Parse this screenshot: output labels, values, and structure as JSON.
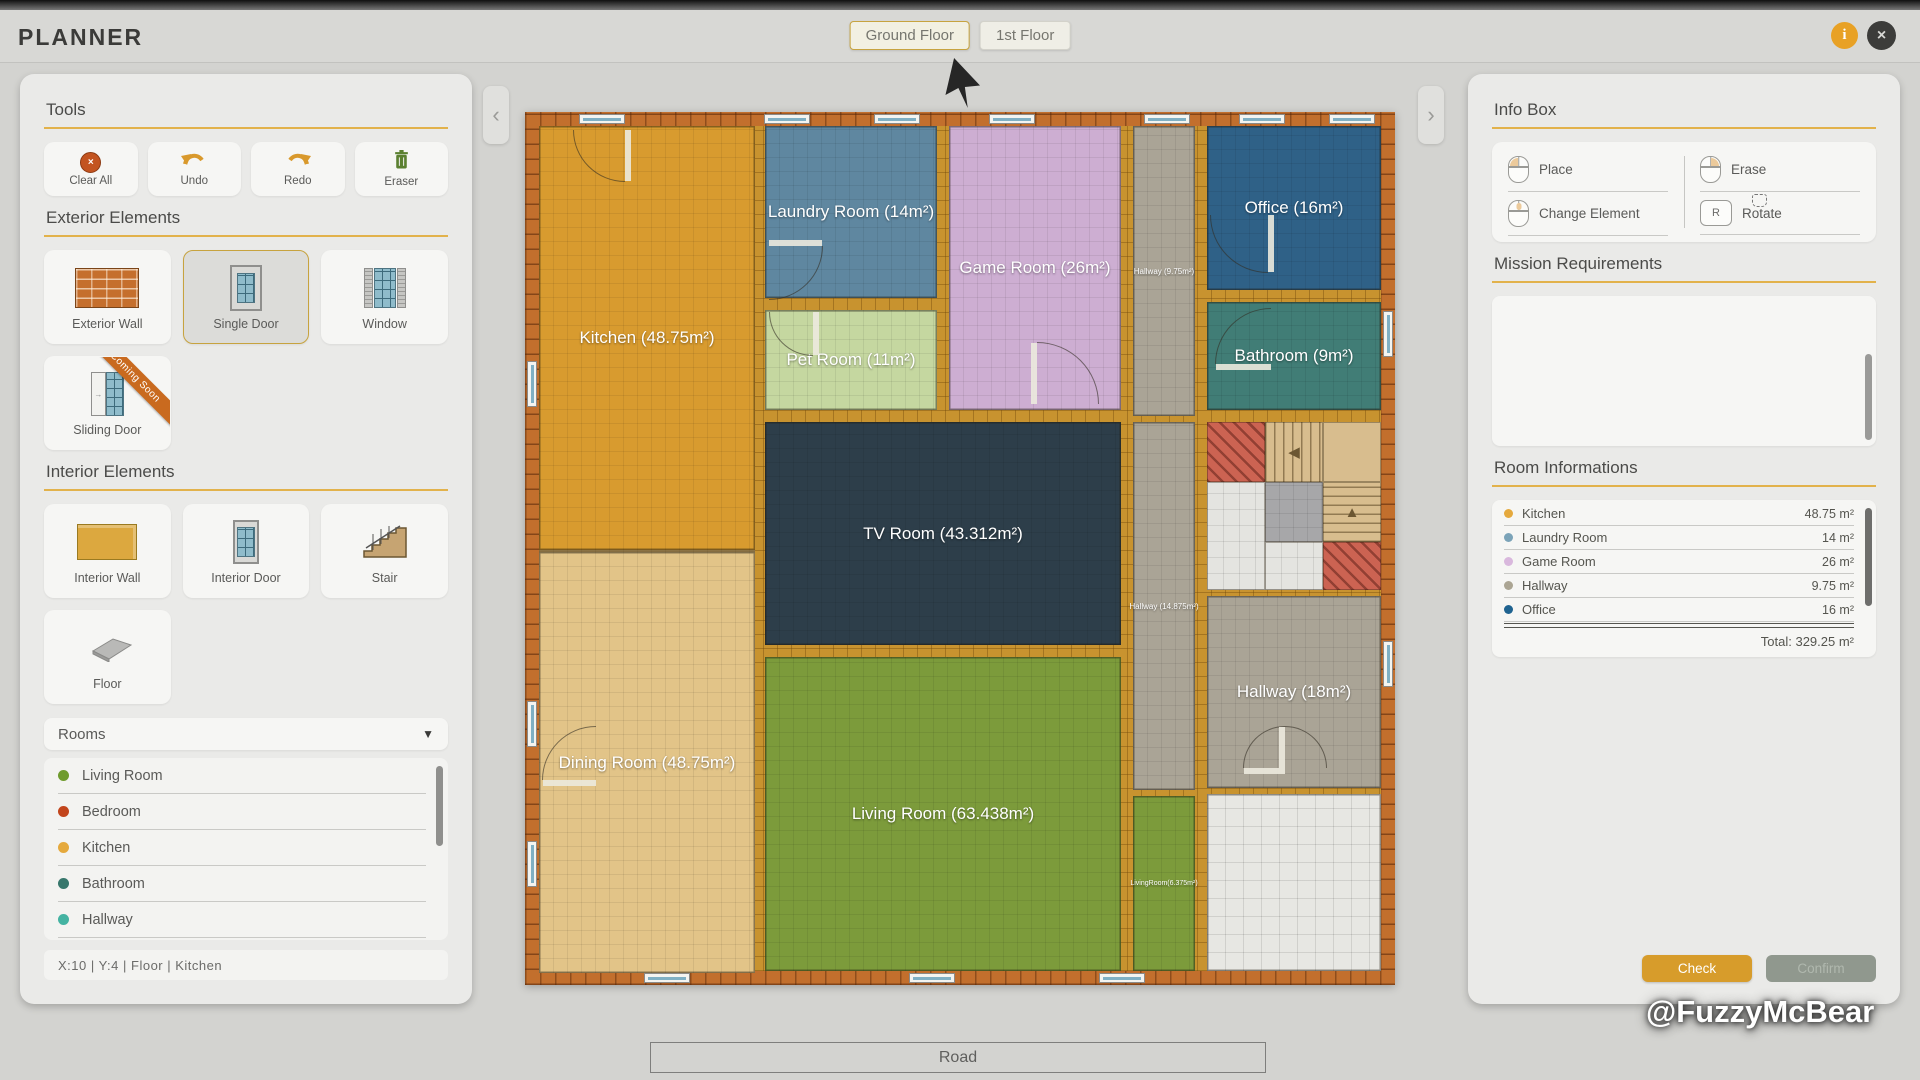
{
  "header": {
    "title": "PLANNER",
    "info_button": "i",
    "close_button": "×",
    "tabs": [
      {
        "label": "Ground Floor",
        "selected": true
      },
      {
        "label": "1st Floor",
        "selected": false
      }
    ]
  },
  "left_panel": {
    "tools": {
      "title": "Tools",
      "items": [
        {
          "label": "Clear All",
          "icon": "clear-all"
        },
        {
          "label": "Undo",
          "icon": "undo"
        },
        {
          "label": "Redo",
          "icon": "redo"
        },
        {
          "label": "Eraser",
          "icon": "eraser"
        }
      ]
    },
    "exterior_elements": {
      "title": "Exterior Elements",
      "items": [
        {
          "label": "Exterior Wall",
          "icon": "exterior-wall",
          "selected": false
        },
        {
          "label": "Single Door",
          "icon": "single-door",
          "selected": true
        },
        {
          "label": "Window",
          "icon": "window",
          "selected": false
        },
        {
          "label": "Sliding Door",
          "icon": "sliding-door",
          "selected": false,
          "ribbon": "Coming Soon"
        }
      ]
    },
    "interior_elements": {
      "title": "Interior Elements",
      "items": [
        {
          "label": "Interior Wall",
          "icon": "interior-wall",
          "selected": false
        },
        {
          "label": "Interior Door",
          "icon": "interior-door",
          "selected": false
        },
        {
          "label": "Stair",
          "icon": "stair",
          "selected": false
        },
        {
          "label": "Floor",
          "icon": "floor",
          "selected": false
        }
      ]
    },
    "rooms_dropdown": {
      "label": "Rooms",
      "options": [
        {
          "label": "Living Room",
          "color": "#6f9b2d"
        },
        {
          "label": "Bedroom",
          "color": "#c2451c"
        },
        {
          "label": "Kitchen",
          "color": "#e5a93d"
        },
        {
          "label": "Bathroom",
          "color": "#37776c"
        },
        {
          "label": "Hallway",
          "color": "#44b3a2"
        },
        {
          "label": "Office",
          "color": "#1f6390"
        }
      ]
    },
    "status_bar": "X:10   |   Y:4   |   Floor   |   Kitchen"
  },
  "right_panel": {
    "info_box": {
      "title": "Info Box",
      "columns": [
        [
          {
            "label": "Place",
            "input": "mouse-left"
          },
          {
            "label": "Change Element",
            "input": "mouse-middle"
          }
        ],
        [
          {
            "label": "Erase",
            "input": "mouse-right"
          },
          {
            "label": "Rotate",
            "input": "key",
            "key": "R"
          }
        ]
      ]
    },
    "mission": {
      "title": "Mission Requirements"
    },
    "room_informations": {
      "title": "Room Informations",
      "rows": [
        {
          "name": "Kitchen",
          "area": "48.75 m²",
          "color": "#e5a93d"
        },
        {
          "name": "Laundry Room",
          "area": "14 m²",
          "color": "#7ba3b8"
        },
        {
          "name": "Game Room",
          "area": "26 m²",
          "color": "#d9b8dd"
        },
        {
          "name": "Hallway",
          "area": "9.75 m²",
          "color": "#aba593"
        },
        {
          "name": "Office",
          "area": "16 m²",
          "color": "#1f6390"
        }
      ],
      "total": "Total: 329.25 m²"
    },
    "buttons": {
      "check": "Check",
      "confirm": "Confirm"
    }
  },
  "floorplan": {
    "rooms": [
      {
        "name": "kitchen",
        "label": "Kitchen (48.75m²)",
        "color": "#d89b2f",
        "rect": [
          0,
          0,
          216,
          424
        ],
        "label_class": "lg"
      },
      {
        "name": "dining-room",
        "label": "Dining Room (48.75m²)",
        "color": "#e2c488",
        "rect": [
          0,
          424,
          216,
          421
        ],
        "label_class": "lg",
        "topline": true
      },
      {
        "name": "laundry-room",
        "label": "Laundry Room (14m²)",
        "color": "#5f87a0",
        "rect": [
          226,
          0,
          172,
          172
        ],
        "label_class": "lg"
      },
      {
        "name": "pet-room",
        "label": "Pet Room (11m²)",
        "color": "#c5d7a0",
        "rect": [
          226,
          184,
          172,
          100
        ],
        "label_class": "lg"
      },
      {
        "name": "game-room",
        "label": "Game Room (26m²)",
        "color": "#cdaed2",
        "rect": [
          410,
          0,
          172,
          284
        ],
        "label_class": "lg"
      },
      {
        "name": "hallway-strip-top",
        "label": "Hallway (9.75m²)",
        "color": "#aaa496",
        "rect": [
          594,
          0,
          62,
          290
        ],
        "label_class": "sm"
      },
      {
        "name": "office",
        "label": "Office (16m²)",
        "color": "#2f6187",
        "rect": [
          668,
          0,
          174,
          164
        ],
        "label_class": "lg"
      },
      {
        "name": "bathroom",
        "label": "Bathroom (9m²)",
        "color": "#417d76",
        "rect": [
          668,
          176,
          174,
          108
        ],
        "label_class": "lg"
      },
      {
        "name": "tv-room",
        "label": "TV Room (43.312m²)",
        "color": "#2d3e4a",
        "rect": [
          226,
          296,
          356,
          223
        ],
        "label_class": "lg"
      },
      {
        "name": "hallway-strip-mid",
        "label": "Hallway (14.875m²)",
        "color": "#aaa496",
        "rect": [
          594,
          296,
          62,
          368
        ],
        "label_class": "sm"
      },
      {
        "name": "hallway",
        "label": "Hallway (18m²)",
        "color": "#aaa496",
        "rect": [
          668,
          470,
          174,
          192
        ],
        "label_class": "lg"
      },
      {
        "name": "living-room",
        "label": "Living Room (63.438m²)",
        "color": "#7c9b3b",
        "rect": [
          226,
          531,
          356,
          314
        ],
        "label_class": "lg"
      },
      {
        "name": "living-room-strip",
        "label": "LivingRoom(6.375m²)",
        "color": "#7c9b3b",
        "rect": [
          594,
          670,
          62,
          175
        ],
        "label_class": "xs"
      },
      {
        "name": "porch",
        "label": "",
        "color": "#e7e7e3",
        "rect": [
          668,
          668,
          174,
          177
        ],
        "label_class": "sm",
        "tile": "light"
      }
    ],
    "stairwell": {
      "rect": [
        668,
        296,
        174,
        168
      ],
      "tiles": [
        {
          "type": "hatch",
          "rect": [
            0,
            0,
            58,
            60
          ]
        },
        {
          "type": "stair-v",
          "rect": [
            58,
            0,
            58,
            60
          ],
          "arrow": "◀"
        },
        {
          "type": "tan",
          "rect": [
            116,
            0,
            58,
            60
          ]
        },
        {
          "type": "tile",
          "rect": [
            0,
            60,
            58,
            108
          ]
        },
        {
          "type": "landing",
          "rect": [
            58,
            60,
            58,
            60
          ]
        },
        {
          "type": "stair-h",
          "rect": [
            116,
            60,
            58,
            60
          ],
          "arrow": "▲"
        },
        {
          "type": "tile",
          "rect": [
            58,
            120,
            58,
            48
          ]
        },
        {
          "type": "hatch",
          "rect": [
            116,
            120,
            58,
            48
          ]
        }
      ]
    },
    "windows": {
      "top": [
        40,
        225,
        335,
        450,
        605,
        700,
        790
      ],
      "left": [
        235,
        575,
        715
      ],
      "bottom": [
        105,
        370,
        560
      ],
      "right": [
        185,
        515
      ]
    },
    "doors": [
      {
        "rect": [
          34,
          4,
          52
        ],
        "rot": 0
      },
      {
        "rect": [
          230,
          120,
          54
        ],
        "rot": 270
      },
      {
        "rect": [
          230,
          186,
          44
        ],
        "rot": 0
      },
      {
        "rect": [
          498,
          216,
          62
        ],
        "rot": 180
      },
      {
        "rect": [
          671,
          89,
          58
        ],
        "rot": 0
      },
      {
        "rect": [
          676,
          182,
          56
        ],
        "rot": 90
      },
      {
        "rect": [
          3,
          600,
          54
        ],
        "rot": 90
      },
      {
        "rect": [
          704,
          600,
          42
        ],
        "rot": 90
      },
      {
        "rect": [
          746,
          600,
          42
        ],
        "rot": 180
      }
    ]
  },
  "footer": {
    "road_label": "Road",
    "watermark": "@FuzzyMcBear"
  }
}
